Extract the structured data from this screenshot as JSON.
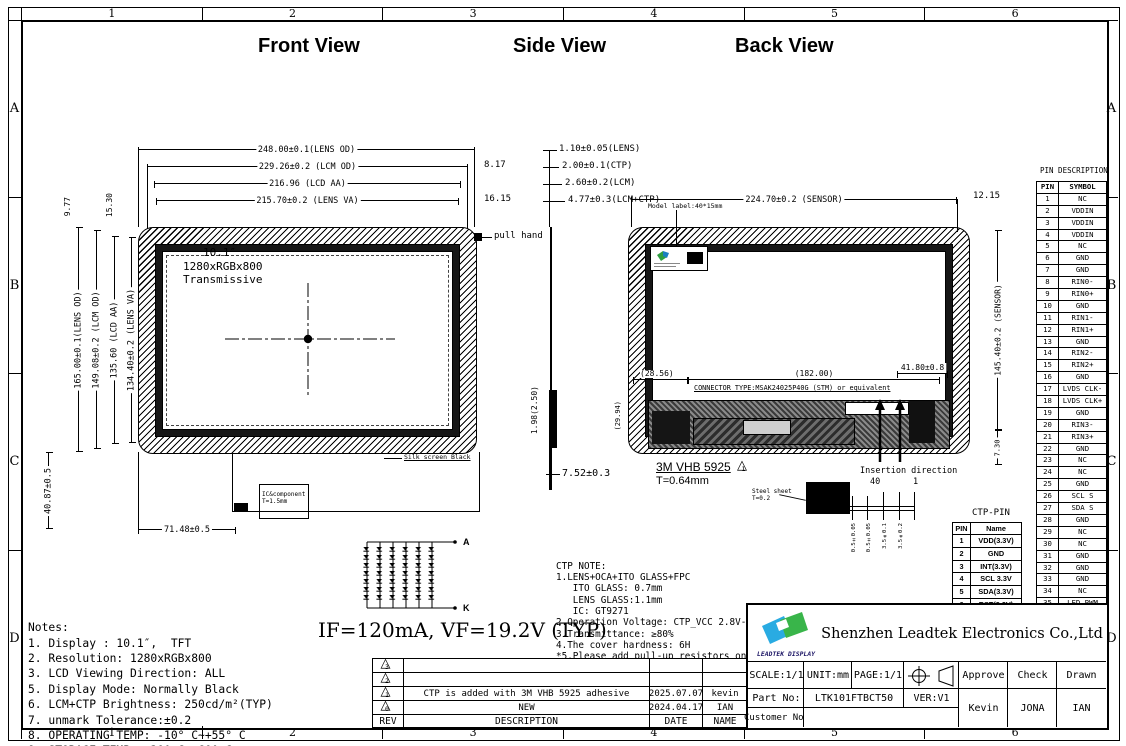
{
  "frame": {
    "columns": [
      "1",
      "2",
      "3",
      "4",
      "5",
      "6"
    ],
    "rows": [
      "A",
      "B",
      "C",
      "D"
    ]
  },
  "view_titles": {
    "front": "Front View",
    "side": "Side View",
    "back": "Back View"
  },
  "front_view": {
    "dim_lens_od_w": "248.00±0.1(LENS OD)",
    "dim_lcm_od_w": "229.26±0.2 (LCM OD)",
    "dim_lcd_aa_w": "216.96 (LCD AA)",
    "dim_lens_va_w": "215.70±0.2 (LENS VA)",
    "dim_offset_right_1": "8.17",
    "dim_offset_right_2": "16.15",
    "dim_lens_od_h": "165.00±0.1(LENS OD)",
    "dim_lcm_od_h": "149.08±0.2 (LCM OD)",
    "dim_lcd_aa_h": "135.60 (LCD AA)",
    "dim_lens_va_h": "134.40±0.2 (LENS VA)",
    "dim_offset_top_1": "9.77",
    "dim_offset_top_2": "15.30",
    "dim_fpc_height": "40.87±0.5",
    "dim_fpc_width": "71.48±0.5",
    "screen_size": "10.1″",
    "screen_resolution": "1280xRGBx800",
    "screen_mode": "Transmissive",
    "pull_hand_label": "pull hand",
    "silk_screen_label": "Silk screen Black",
    "ic_component_label": "IC&component",
    "ic_component_thickness": "T=1.5mm"
  },
  "side_view": {
    "dim_lens": "1.10±0.05(LENS)",
    "dim_ctp": "2.00±0.1(CTP)",
    "dim_lcm": "2.60±0.2(LCM)",
    "dim_lcm_ctp": "4.77±0.3(LCM+CTP)",
    "dim_fpc": "1.98(2.50)",
    "dim_total": "7.52±0.3"
  },
  "back_view": {
    "dim_sensor_w": "224.70±0.2 (SENSOR)",
    "dim_offset_right": "12.15",
    "model_label": "Model label:40*15mm",
    "dim_sensor_h": "145.40±0.2 (SENSOR)",
    "dim_bottom_gap": "7.30",
    "dim_connector_offset": "41.80±0.8",
    "dim_pcb_left": "(28.56)",
    "dim_pcb_width": "(182.00)",
    "dim_pcb_height": "(29.94)",
    "connector_type": "CONNECTOR TYPE:MSAK24025P40G (STM) or equivalent",
    "adhesive_label": "3M VHB 5925",
    "adhesive_mark": "1",
    "adhesive_thickness": "T=0.64mm",
    "insertion_label": "Insertion direction",
    "insertion_pin_40": "40",
    "insertion_pin_1": "1",
    "steel_sheet_label": "Steel sheet",
    "steel_sheet_thickness": "T=0.2",
    "fpc_dims": [
      "0.5±0.05",
      "0.5±0.05",
      "3.5±0.1",
      "3.5±0.2"
    ]
  },
  "pin_table": {
    "title": "PIN DESCRIPTION",
    "header": {
      "pin": "PIN",
      "symbol": "SYMBOL"
    },
    "rows": [
      {
        "pin": "1",
        "symbol": "NC"
      },
      {
        "pin": "2",
        "symbol": "VDDIN"
      },
      {
        "pin": "3",
        "symbol": "VDDIN"
      },
      {
        "pin": "4",
        "symbol": "VDDIN"
      },
      {
        "pin": "5",
        "symbol": "NC"
      },
      {
        "pin": "6",
        "symbol": "GND"
      },
      {
        "pin": "7",
        "symbol": "GND"
      },
      {
        "pin": "8",
        "symbol": "RIN0-"
      },
      {
        "pin": "9",
        "symbol": "RIN0+"
      },
      {
        "pin": "10",
        "symbol": "GND"
      },
      {
        "pin": "11",
        "symbol": "RIN1-"
      },
      {
        "pin": "12",
        "symbol": "RIN1+"
      },
      {
        "pin": "13",
        "symbol": "GND"
      },
      {
        "pin": "14",
        "symbol": "RIN2-"
      },
      {
        "pin": "15",
        "symbol": "RIN2+"
      },
      {
        "pin": "16",
        "symbol": "GND"
      },
      {
        "pin": "17",
        "symbol": "LVDS CLK-"
      },
      {
        "pin": "18",
        "symbol": "LVDS CLK+"
      },
      {
        "pin": "19",
        "symbol": "GND"
      },
      {
        "pin": "20",
        "symbol": "RIN3-"
      },
      {
        "pin": "21",
        "symbol": "RIN3+"
      },
      {
        "pin": "22",
        "symbol": "GND"
      },
      {
        "pin": "23",
        "symbol": "NC"
      },
      {
        "pin": "24",
        "symbol": "NC"
      },
      {
        "pin": "25",
        "symbol": "GND"
      },
      {
        "pin": "26",
        "symbol": "SCL S"
      },
      {
        "pin": "27",
        "symbol": "SDA S"
      },
      {
        "pin": "28",
        "symbol": "GND"
      },
      {
        "pin": "29",
        "symbol": "NC"
      },
      {
        "pin": "30",
        "symbol": "NC"
      },
      {
        "pin": "31",
        "symbol": "GND"
      },
      {
        "pin": "32",
        "symbol": "GND"
      },
      {
        "pin": "33",
        "symbol": "GND"
      },
      {
        "pin": "34",
        "symbol": "NC"
      },
      {
        "pin": "35",
        "symbol": "LED PWM"
      },
      {
        "pin": "36",
        "symbol": "NC"
      },
      {
        "pin": "37",
        "symbol": "NC"
      },
      {
        "pin": "38",
        "symbol": "LED+"
      },
      {
        "pin": "39",
        "symbol": "LED+"
      },
      {
        "pin": "40",
        "symbol": "LED+"
      }
    ]
  },
  "ctp_pin_table": {
    "title": "CTP-PIN",
    "header": {
      "pin": "PIN",
      "name": "Name"
    },
    "rows": [
      {
        "pin": "1",
        "name": "VDD(3.3V)"
      },
      {
        "pin": "2",
        "name": "GND"
      },
      {
        "pin": "3",
        "name": "INT(3.3V)"
      },
      {
        "pin": "4",
        "name": "SCL 3.3V"
      },
      {
        "pin": "5",
        "name": "SDA(3.3V)"
      },
      {
        "pin": "6",
        "name": "RST(3.3V)"
      }
    ]
  },
  "ctp_note": {
    "lines": [
      "CTP NOTE:",
      "1.LENS+OCA+ITO GLASS+FPC",
      "   ITO GLASS: 0.7mm",
      "   LENS GLASS:1.1mm",
      "   IC: GT9271",
      "2.Operation Voltage: CTP_VCC 2.8V-3.3 V",
      "3.Transmittance: ≥80%",
      "4.The cover hardness: 6H",
      "*5.Please add pull-up resistors on",
      "   the motherboard for SDA and SCL"
    ]
  },
  "notes": {
    "lines": [
      "Notes:",
      "1. Display : 10.1″,  TFT",
      "2. Resolution: 1280xRGBx800",
      "3. LCD Viewing Direction: ALL",
      "5. Display Mode: Normally Black",
      "6. LCM+CTP Brightness: 250cd/m²(TYP)",
      "7. unmark Tolerance:±0.2",
      "8. OPERATING TEMP: -10° C~+55° C",
      "9. STORAGE TEMP: -20° C~+60° C",
      "10. Requirements on Environmental Protection: ROHS"
    ]
  },
  "backlight": {
    "anode": "A",
    "cathode": "K",
    "spec": "IF=120mA, VF=19.2V (TYP)"
  },
  "revision_table": {
    "header": {
      "rev": "REV",
      "description": "DESCRIPTION",
      "date": "DATE",
      "name": "NAME"
    },
    "rows": [
      {
        "rev": "3",
        "description": "",
        "date": "",
        "name": ""
      },
      {
        "rev": "2",
        "description": "",
        "date": "",
        "name": ""
      },
      {
        "rev": "1",
        "description": "CTP is added with 3M VHB 5925 adhesive",
        "date": "2025.07.07",
        "name": "kevin"
      },
      {
        "rev": "0",
        "description": "NEW",
        "date": "2024.04.17",
        "name": "IAN"
      }
    ]
  },
  "title_block": {
    "company": "Shenzhen Leadtek Electronics Co.,Ltd",
    "logo_text": "LEADTEK DISPLAY",
    "scale": "SCALE:1/1",
    "unit": "UNIT:mm",
    "page": "PAGE:1/1",
    "approve_label": "Approve",
    "check_label": "Check",
    "drawn_label": "Drawn",
    "part_no_label": "Part No:",
    "part_no": "LTK101FTBCT50",
    "ver": "VER:V1",
    "customer_no_label": "Customer No:",
    "customer_no": "",
    "approve_name": "Kevin",
    "check_name": "JONA",
    "drawn_name": "IAN"
  },
  "colors": {
    "line": "#000000",
    "background": "#ffffff",
    "logo_blue": "#29abe2",
    "logo_green": "#39b54a",
    "logo_text_blue": "#1b1464",
    "label_green": "#2f9e41"
  }
}
